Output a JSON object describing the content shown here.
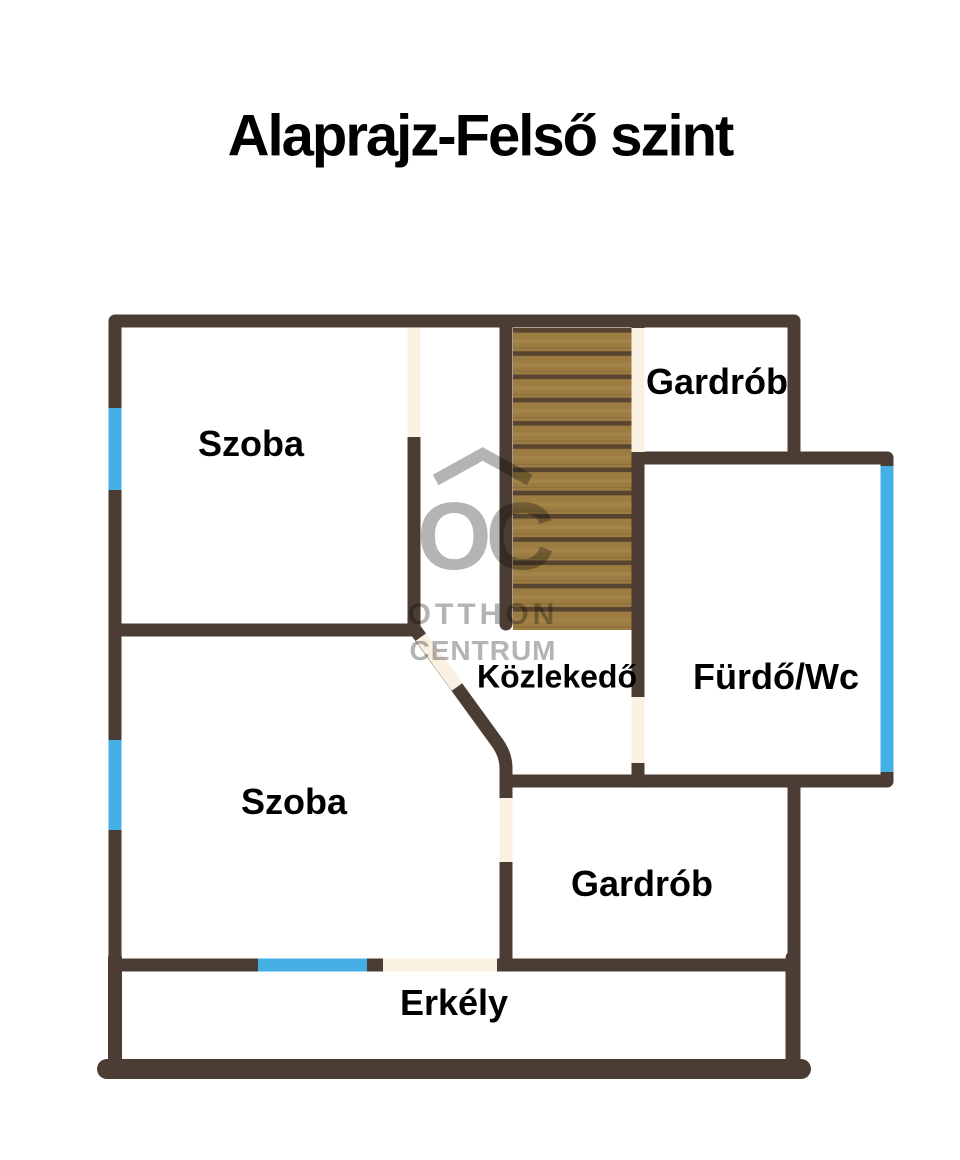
{
  "title": "Alaprajz-Felső szint",
  "rooms": [
    {
      "name": "szoba-top",
      "label": "Szoba"
    },
    {
      "name": "gardrob-top",
      "label": "Gardrób"
    },
    {
      "name": "furdo-wc",
      "label": "Fürdő/Wc"
    },
    {
      "name": "kozlekedo",
      "label": "Közlekedő"
    },
    {
      "name": "szoba-bottom",
      "label": "Szoba"
    },
    {
      "name": "gardrob-bottom",
      "label": "Gardrób"
    },
    {
      "name": "erkely",
      "label": "Erkély"
    }
  ],
  "watermark": {
    "logo_text": "OC",
    "line1": "OTTHON",
    "line2": "CENTRUM"
  },
  "colors": {
    "background": "#ffffff",
    "text": "#000000",
    "wall": "#4b3d33",
    "window": "#45aee4",
    "door": "#fbf1e3",
    "stair_wood": "#9c7c41",
    "stair_groove": "#584430",
    "stair_highlight": "#ab8b4e",
    "watermark": "#b4b4b4"
  }
}
